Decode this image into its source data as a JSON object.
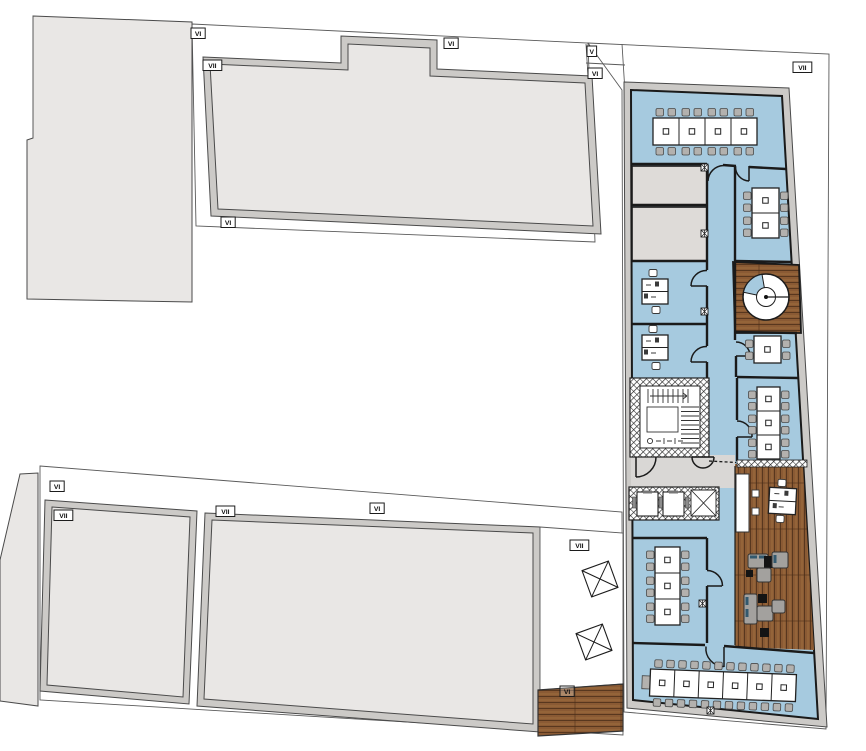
{
  "meta": {
    "kind": "architectural-floor-plan",
    "level_shown": "office level with terraces"
  },
  "palette": {
    "floor_blue": "#a6cadf",
    "counter_blue": "#bcd8ea",
    "wood_mid": "#8a5a34",
    "wood_light": "#9d6b3e",
    "wood_dark": "#58371e",
    "room_gray": "#dedbd8",
    "neighbor_fill": "#e9e7e5",
    "wall_band": "#cccac7",
    "outline": "#4a4a4a",
    "wall_dark": "#1a1a1a",
    "chair_gray": "#b3b1ae",
    "sofa_gray": "#a3a19e",
    "sofa_accent": "#33596e"
  },
  "labels": [
    {
      "text": "VI",
      "x": 191,
      "y": 28
    },
    {
      "text": "VII",
      "x": 203,
      "y": 60
    },
    {
      "text": "VI",
      "x": 444,
      "y": 38
    },
    {
      "text": "V",
      "x": 587,
      "y": 46
    },
    {
      "text": "VI",
      "x": 588,
      "y": 68
    },
    {
      "text": "VII",
      "x": 793,
      "y": 62
    },
    {
      "text": "VI",
      "x": 221,
      "y": 217
    },
    {
      "text": "VI",
      "x": 50,
      "y": 481
    },
    {
      "text": "VII",
      "x": 54,
      "y": 510
    },
    {
      "text": "VII",
      "x": 216,
      "y": 506
    },
    {
      "text": "VI",
      "x": 370,
      "y": 503
    },
    {
      "text": "VII",
      "x": 570,
      "y": 540
    },
    {
      "text": "VI",
      "x": 560,
      "y": 686,
      "dark": true
    }
  ],
  "icons": {
    "wall_vent_markers": [
      [
        701,
        164
      ],
      [
        701,
        230
      ],
      [
        701,
        308
      ],
      [
        699,
        600
      ],
      [
        707,
        707
      ]
    ],
    "skylights": [
      {
        "x": 600,
        "y": 579,
        "rot": -20
      },
      {
        "x": 594,
        "y": 642,
        "rot": -20
      }
    ]
  }
}
